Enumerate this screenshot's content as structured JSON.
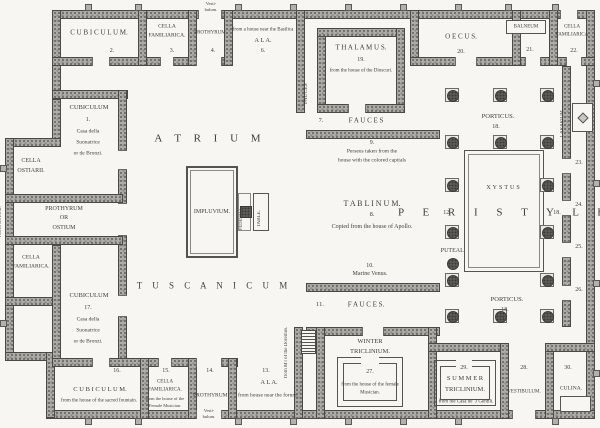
{
  "palette": {
    "paper": "#f7f6f2",
    "wall_gray": "#aeaca7",
    "ink": "#3f3e3b"
  },
  "rooms": {
    "atrium": {
      "name": "A T R I U M",
      "sub": "T U S C A N I C U M"
    },
    "impluvium": {
      "name": "IMPLUVIUM.",
      "pedestal": "PEDESTAL.",
      "table": "TABLE."
    },
    "fauces_upper": {
      "num": "7.",
      "name": "F A U C E S"
    },
    "fauces_lower": {
      "num": "11.",
      "name": "F A U C E S."
    },
    "fauces_side": {
      "name": "FAUCES"
    },
    "tablinum": {
      "num_top": "9.",
      "note_top1": "Perseus taken from the",
      "note_top2": "house with the colored capitals",
      "name": "T A B L I N U M.",
      "num": "8.",
      "note": "Copied from the house of Apollo.",
      "num_bottom": "10.",
      "note_bottom": "Marine Venus."
    },
    "thalamus": {
      "name": "T H A L A M U S.",
      "num": "19.",
      "note": "from the house of the Dioscuri."
    },
    "cubiculum_top": {
      "name": "C U B I C U L U M.",
      "num": "2."
    },
    "cella_familiarica_top": {
      "line1": "CELLA",
      "line2": "FAMILIARICA.",
      "num": "3."
    },
    "prothyrum_top": {
      "name": "PROTHYRUM",
      "num": "4.",
      "vest1": "Vesti-",
      "vest2": "bulum."
    },
    "ala_top": {
      "note": "from a house near the Basilica",
      "name": "A L A.",
      "num": "6."
    },
    "oecus": {
      "name": "O E C U S.",
      "num": "20."
    },
    "balneum_room": {
      "box": "BALNEUM",
      "num": "21."
    },
    "cella_familiarica_right": {
      "line1": "CELLA",
      "line2": "FAMILIARICA",
      "num": "22."
    },
    "lararium": {
      "name": "LARARIUM."
    },
    "posticum_doors": {
      "n1": "23.",
      "n2": "24.",
      "n3": "25.",
      "n4": "26."
    },
    "porticus_top": {
      "name": "PORTICUS.",
      "num": "18."
    },
    "porticus_bottom": {
      "name": "PORTICUS.",
      "num": "18."
    },
    "peristyle": {
      "name": "P E R I S T Y L E",
      "num_left": "12.",
      "num_right": "18."
    },
    "xystus": {
      "name": "XYSTUS"
    },
    "puteal": {
      "name": "PUTEAL."
    },
    "cubiculum_left": {
      "name": "CUBICULUM",
      "num": "1.",
      "note1": "Casa della",
      "note2": "Suonatrice",
      "note3": "or de Bronzi."
    },
    "cella_ostiarii": {
      "line1": "CELLA",
      "line2": "OSTIARII."
    },
    "prothyrum_left": {
      "line1": "PROTHYRUM",
      "line2": "OR",
      "line3": "OSTIUM",
      "vest": "VESTI-BULUM."
    },
    "cella_familiarica_left": {
      "line1": "CELLA",
      "line2": "FAMILIARICA."
    },
    "cubiculum_left2": {
      "name": "CUBICULUM",
      "num": "17.",
      "note1": "Casa della",
      "note2": "Suonatrice",
      "note3": "or de Bronzi."
    },
    "cubiculum_bottom": {
      "num": "16.",
      "name": "C U B I C U L U M.",
      "note": "from the house of the sacred fountain."
    },
    "cella_familiarica_bottom": {
      "num": "15.",
      "line1": "CELLA",
      "line2": "FAMILIARICA.",
      "note1": "from the house of the",
      "note2": "Female Musician."
    },
    "prothyrum_bottom": {
      "num": "14.",
      "name": "PROTHYRUM.",
      "vest1": "Vesti-",
      "vest2": "bulum."
    },
    "ala_bottom": {
      "num": "13.",
      "name": "A L A.",
      "note": "from house near the forum."
    },
    "doremus_note": {
      "text": "from M'l of the Doremus."
    },
    "winter_triclinium": {
      "line1": "WINTER",
      "line2": "TRICLINIUM.",
      "num": "27.",
      "note1": "from the house of the female",
      "note2": "Musician."
    },
    "summer_triclinium": {
      "num": "29.",
      "line1": "S U M M E R",
      "line2": "TRICLINIUM.",
      "note": "from the Casa de' 3 Gentili."
    },
    "vestibulum_right": {
      "num": "28.",
      "name": "VESTIBULUM."
    },
    "culina": {
      "num": "30.",
      "name": "CULINA."
    }
  }
}
